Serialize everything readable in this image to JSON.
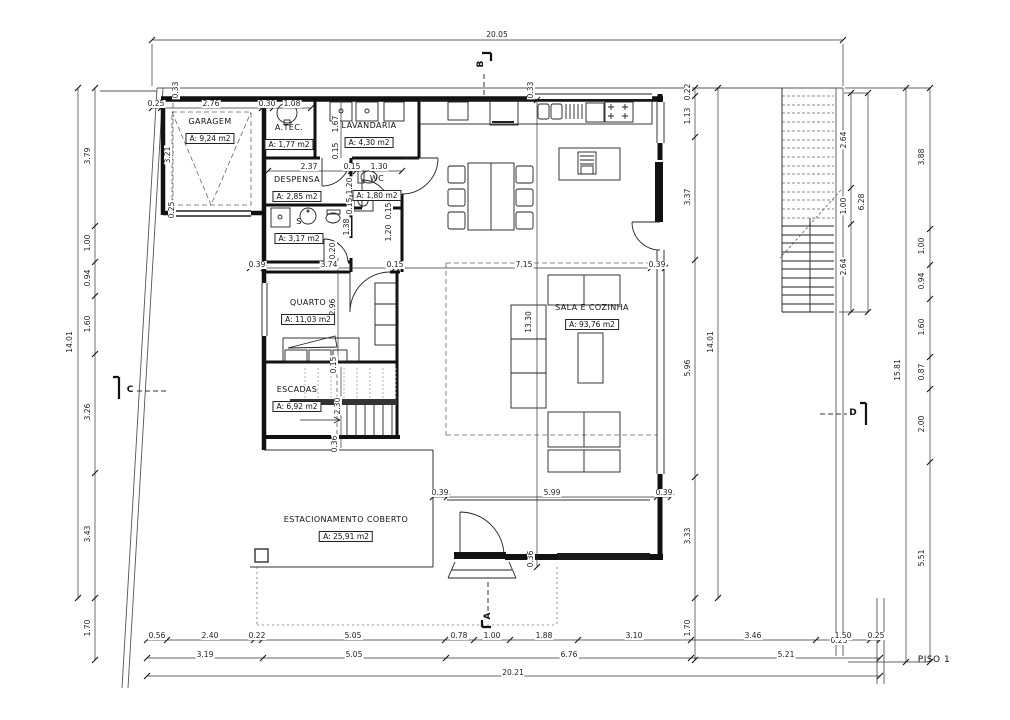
{
  "title": "PISO 1",
  "rooms": [
    {
      "name": "GARAGEM",
      "area": "A: 9,24 m2",
      "x": 210,
      "y": 131
    },
    {
      "name": "A.TÉC.",
      "area": "A: 1,77 m2",
      "x": 289,
      "y": 137
    },
    {
      "name": "LAVANDARIA",
      "area": "A: 4,30 m2",
      "x": 369,
      "y": 135
    },
    {
      "name": "DESPENSA",
      "area": "A: 2,85 m2",
      "x": 297,
      "y": 189
    },
    {
      "name": "WC",
      "area": "A: 1,80 m2",
      "x": 377,
      "y": 188
    },
    {
      "name": "S",
      "area": "A: 3,17 m2",
      "x": 299,
      "y": 231
    },
    {
      "name": "QUARTO",
      "area": "A: 11,03 m2",
      "x": 308,
      "y": 312
    },
    {
      "name": "ESCADAS",
      "area": "A: 6,92 m2",
      "x": 297,
      "y": 399
    },
    {
      "name": "SALA E COZINHA",
      "area": "A: 93,76 m2",
      "x": 592,
      "y": 317
    },
    {
      "name": "ESTACIONAMENTO COBERTO",
      "area": "A: 25,91 m2",
      "x": 346,
      "y": 529
    }
  ],
  "dims": [
    {
      "t": "20.05",
      "x": 497,
      "y": 35,
      "r": 0
    },
    {
      "t": "0.25",
      "x": 156,
      "y": 104,
      "r": 0
    },
    {
      "t": "2.76",
      "x": 211,
      "y": 104,
      "r": 0
    },
    {
      "t": "0.30",
      "x": 267,
      "y": 104,
      "r": 0
    },
    {
      "t": "1.08",
      "x": 292,
      "y": 104,
      "r": 0
    },
    {
      "t": "0.33",
      "x": 176,
      "y": 90,
      "r": 1
    },
    {
      "t": "3.21",
      "x": 168,
      "y": 155,
      "r": 1
    },
    {
      "t": "0.25",
      "x": 172,
      "y": 210,
      "r": 1
    },
    {
      "t": "1.67",
      "x": 336,
      "y": 124,
      "r": 1
    },
    {
      "t": "0.15",
      "x": 336,
      "y": 151,
      "r": 1
    },
    {
      "t": "2.37",
      "x": 309,
      "y": 167,
      "r": 0
    },
    {
      "t": "0.15",
      "x": 352,
      "y": 167,
      "r": 0
    },
    {
      "t": "1.30",
      "x": 379,
      "y": 167,
      "r": 0
    },
    {
      "t": "1.20",
      "x": 350,
      "y": 186,
      "r": 1
    },
    {
      "t": "0.15",
      "x": 350,
      "y": 206,
      "r": 1
    },
    {
      "t": "1.38",
      "x": 347,
      "y": 227,
      "r": 1
    },
    {
      "t": "0.15",
      "x": 389,
      "y": 211,
      "r": 1
    },
    {
      "t": "1.20",
      "x": 389,
      "y": 233,
      "r": 1
    },
    {
      "t": "0.20",
      "x": 333,
      "y": 251,
      "r": 1
    },
    {
      "t": "0.33",
      "x": 531,
      "y": 90,
      "r": 1
    },
    {
      "t": "0.39",
      "x": 257,
      "y": 265,
      "r": 0
    },
    {
      "t": "3.74",
      "x": 329,
      "y": 265,
      "r": 0
    },
    {
      "t": "0.15",
      "x": 395,
      "y": 265,
      "r": 0
    },
    {
      "t": "7.15",
      "x": 524,
      "y": 265,
      "r": 0
    },
    {
      "t": "0.39",
      "x": 657,
      "y": 265,
      "r": 0
    },
    {
      "t": "2.96",
      "x": 333,
      "y": 307,
      "r": 1
    },
    {
      "t": "13.30",
      "x": 529,
      "y": 322,
      "r": 1
    },
    {
      "t": "0.15",
      "x": 334,
      "y": 365,
      "r": 1
    },
    {
      "t": "2.30",
      "x": 338,
      "y": 406,
      "r": 1
    },
    {
      "t": "0.36",
      "x": 335,
      "y": 444,
      "r": 1
    },
    {
      "t": "0.39",
      "x": 440,
      "y": 493,
      "r": 0
    },
    {
      "t": "5.99",
      "x": 552,
      "y": 493,
      "r": 0
    },
    {
      "t": "0.39",
      "x": 664,
      "y": 493,
      "r": 0
    },
    {
      "t": "0.36",
      "x": 531,
      "y": 559,
      "r": 1
    },
    {
      "t": "3.79",
      "x": 88,
      "y": 156,
      "r": 1
    },
    {
      "t": "1.00",
      "x": 88,
      "y": 243,
      "r": 1
    },
    {
      "t": "0.94",
      "x": 88,
      "y": 278,
      "r": 1
    },
    {
      "t": "1.60",
      "x": 88,
      "y": 324,
      "r": 1
    },
    {
      "t": "3.26",
      "x": 88,
      "y": 412,
      "r": 1
    },
    {
      "t": "3.43",
      "x": 88,
      "y": 534,
      "r": 1
    },
    {
      "t": "1.70",
      "x": 88,
      "y": 628,
      "r": 1
    },
    {
      "t": "14.01",
      "x": 70,
      "y": 342,
      "r": 1
    },
    {
      "t": "0.22",
      "x": 688,
      "y": 92,
      "r": 1
    },
    {
      "t": "1.13",
      "x": 688,
      "y": 116,
      "r": 1
    },
    {
      "t": "3.37",
      "x": 688,
      "y": 197,
      "r": 1
    },
    {
      "t": "5.96",
      "x": 688,
      "y": 368,
      "r": 1
    },
    {
      "t": "3.33",
      "x": 688,
      "y": 536,
      "r": 1
    },
    {
      "t": "1.70",
      "x": 688,
      "y": 628,
      "r": 1
    },
    {
      "t": "14.01",
      "x": 711,
      "y": 342,
      "r": 1
    },
    {
      "t": "2.64",
      "x": 844,
      "y": 140,
      "r": 1
    },
    {
      "t": "1.00",
      "x": 844,
      "y": 206,
      "r": 1
    },
    {
      "t": "2.64",
      "x": 844,
      "y": 267,
      "r": 1
    },
    {
      "t": "6.28",
      "x": 862,
      "y": 202,
      "r": 1
    },
    {
      "t": "0.25",
      "x": 839,
      "y": 641,
      "r": 0
    },
    {
      "t": "3.88",
      "x": 922,
      "y": 157,
      "r": 1
    },
    {
      "t": "1.00",
      "x": 922,
      "y": 246,
      "r": 1
    },
    {
      "t": "0.94",
      "x": 922,
      "y": 281,
      "r": 1
    },
    {
      "t": "1.60",
      "x": 922,
      "y": 327,
      "r": 1
    },
    {
      "t": "0.87",
      "x": 922,
      "y": 372,
      "r": 1
    },
    {
      "t": "2.00",
      "x": 922,
      "y": 424,
      "r": 1
    },
    {
      "t": "5.51",
      "x": 922,
      "y": 558,
      "r": 1
    },
    {
      "t": "15.81",
      "x": 898,
      "y": 370,
      "r": 1
    },
    {
      "t": "0.56",
      "x": 157,
      "y": 636,
      "r": 0
    },
    {
      "t": "2.40",
      "x": 210,
      "y": 636,
      "r": 0
    },
    {
      "t": "0.22",
      "x": 257,
      "y": 636,
      "r": 0
    },
    {
      "t": "5.05",
      "x": 353,
      "y": 636,
      "r": 0
    },
    {
      "t": "0.78",
      "x": 459,
      "y": 636,
      "r": 0
    },
    {
      "t": "1.00",
      "x": 492,
      "y": 636,
      "r": 0
    },
    {
      "t": "1.88",
      "x": 544,
      "y": 636,
      "r": 0
    },
    {
      "t": "3.10",
      "x": 634,
      "y": 636,
      "r": 0
    },
    {
      "t": "3.46",
      "x": 753,
      "y": 636,
      "r": 0
    },
    {
      "t": "1.50",
      "x": 843,
      "y": 636,
      "r": 0
    },
    {
      "t": "0.25",
      "x": 876,
      "y": 636,
      "r": 0
    },
    {
      "t": "3.19",
      "x": 205,
      "y": 655,
      "r": 0
    },
    {
      "t": "5.05",
      "x": 354,
      "y": 655,
      "r": 0
    },
    {
      "t": "6.76",
      "x": 569,
      "y": 655,
      "r": 0
    },
    {
      "t": "5.21",
      "x": 786,
      "y": 655,
      "r": 0
    },
    {
      "t": "20.21",
      "x": 513,
      "y": 673,
      "r": 0
    }
  ],
  "markers": [
    {
      "t": "B",
      "x": 481,
      "y": 64,
      "r": 1
    },
    {
      "t": "A",
      "x": 488,
      "y": 616,
      "r": 1
    },
    {
      "t": "C",
      "x": 130,
      "y": 390,
      "r": 0
    },
    {
      "t": "D",
      "x": 853,
      "y": 413,
      "r": 0
    }
  ]
}
